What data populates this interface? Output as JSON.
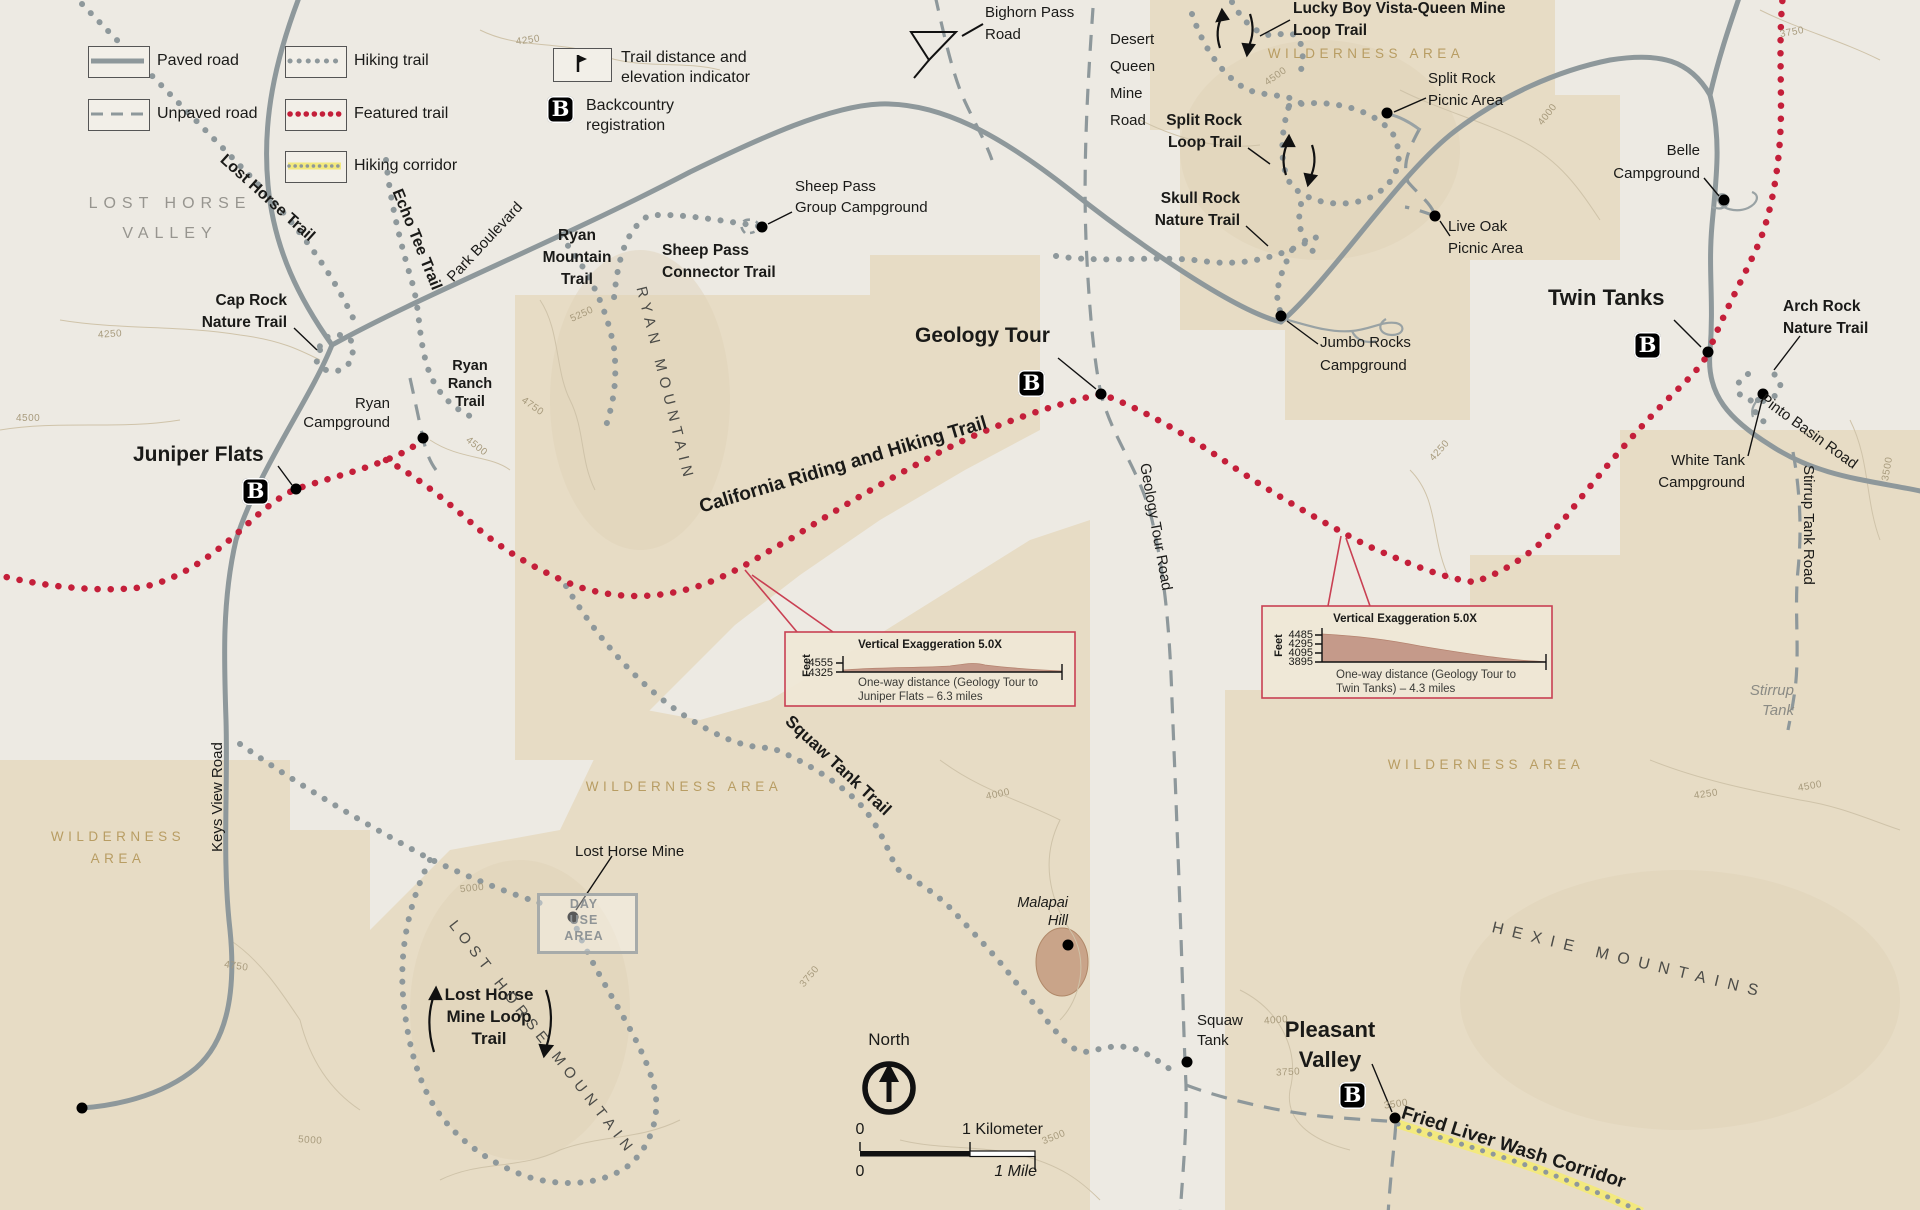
{
  "legend": {
    "paved": "Paved road",
    "unpaved": "Unpaved road",
    "hiking": "Hiking trail",
    "featured": "Featured trail",
    "corridor": "Hiking corridor",
    "indicator": [
      "Trail distance and",
      "elevation indicator"
    ],
    "backcountry": [
      "Backcountry",
      "registration"
    ]
  },
  "b": "B",
  "compass": {
    "north": "North"
  },
  "scale": {
    "zero_km": "0",
    "one_km": "1 Kilometer",
    "zero_mi": "0",
    "one_mi": "1 Mile"
  },
  "profiles": {
    "left": {
      "title": "Vertical Exaggeration 5.0X",
      "feet": "Feet",
      "ticks": [
        "4555",
        "4325"
      ],
      "caption": [
        "One-way distance (Geology Tour to",
        "Juniper Flats – 6.3  miles"
      ]
    },
    "right": {
      "title": "Vertical Exaggeration 5.0X",
      "feet": "Feet",
      "ticks": [
        "4485",
        "4295",
        "4095",
        "3895"
      ],
      "caption": [
        "One-way distance (Geology Tour to",
        "Twin Tanks) – 4.3  miles"
      ]
    }
  },
  "labels": {
    "lost_horse_valley": [
      "LOST HORSE",
      "VALLEY"
    ],
    "lost_horse_trail": "Lost Horse Trail",
    "echo_tee_trail": "Echo Tee Trail",
    "park_boulevard": "Park Boulevard",
    "ryan_mountain_trail": [
      "Ryan",
      "Mountain",
      "Trail"
    ],
    "cap_rock": [
      "Cap Rock",
      "Nature Trail"
    ],
    "ryan_ranch": [
      "Ryan",
      "Ranch",
      "Trail"
    ],
    "ryan_campground": [
      "Ryan",
      "Campground"
    ],
    "juniper_flats": "Juniper Flats",
    "sheep_pass_cg": [
      "Sheep Pass",
      "Group Campground"
    ],
    "sheep_pass_connector": [
      "Sheep Pass",
      "Connector Trail"
    ],
    "bighorn": [
      "Bighorn Pass",
      "Road"
    ],
    "desert_queen": [
      "Desert",
      "Queen",
      "Mine",
      "Road"
    ],
    "lucky_boy": [
      "Lucky Boy Vista-Queen Mine",
      "Loop Trail"
    ],
    "wilderness_tr": "WILDERNESS AREA",
    "split_rock_picnic": [
      "Split Rock",
      "Picnic Area"
    ],
    "split_rock_loop": [
      "Split Rock",
      "Loop Trail"
    ],
    "skull_rock": [
      "Skull Rock",
      "Nature Trail"
    ],
    "live_oak": [
      "Live Oak",
      "Picnic Area"
    ],
    "belle": [
      "Belle",
      "Campground"
    ],
    "jumbo": [
      "Jumbo Rocks",
      "Campground"
    ],
    "twin_tanks": "Twin Tanks",
    "arch_rock": [
      "Arch Rock",
      "Nature Trail"
    ],
    "white_tank": [
      "White Tank",
      "Campground"
    ],
    "pinto_basin": "Pinto Basin Road",
    "stirrup_road": "Stirrup Tank Road",
    "stirrup_tank": [
      "Stirrup",
      "Tank"
    ],
    "geology_tour": "Geology Tour",
    "california": "California Riding and Hiking Trail",
    "geology_road": "Geology Tour Road",
    "squaw_trail": "Squaw Tank Trail",
    "wilderness_c": "WILDERNESS  AREA",
    "wilderness_l": [
      "WILDERNESS",
      "AREA"
    ],
    "wilderness_r": "WILDERNESS  AREA",
    "hexie": "HEXIE MOUNTAINS",
    "keys_view": "Keys View Road",
    "lost_horse_mine": "Lost Horse Mine",
    "day_use": [
      "DAY",
      "USE",
      "AREA"
    ],
    "lhm_loop": [
      "Lost Horse",
      "Mine Loop",
      "Trail"
    ],
    "lost_horse_mountain": "LOST HORSE MOUNTAIN",
    "ryan_mountain": "RYAN MOUNTAIN",
    "malapai": [
      "Malapai",
      "Hill"
    ],
    "squaw_tank": [
      "Squaw",
      "Tank"
    ],
    "pleasant_valley": [
      "Pleasant",
      "Valley"
    ],
    "fried_liver": "Fried Liver Wash Corridor"
  },
  "contours": [
    "4250",
    "4250",
    "4500",
    "5250",
    "4750",
    "4500",
    "5000",
    "4750",
    "5000",
    "4000",
    "3500",
    "4000",
    "3750",
    "3500",
    "4250",
    "4000",
    "3750",
    "3500",
    "4500",
    "4250",
    "4500",
    "3750"
  ],
  "colors": {
    "featured_trail": "#c41f3a",
    "trail_gray": "#8e989b",
    "wilderness_tan": "#e7dcc5",
    "corridor_yellow": "#f3e97e",
    "profile_fill": "#c59a8a",
    "profile_border": "#c94053"
  }
}
